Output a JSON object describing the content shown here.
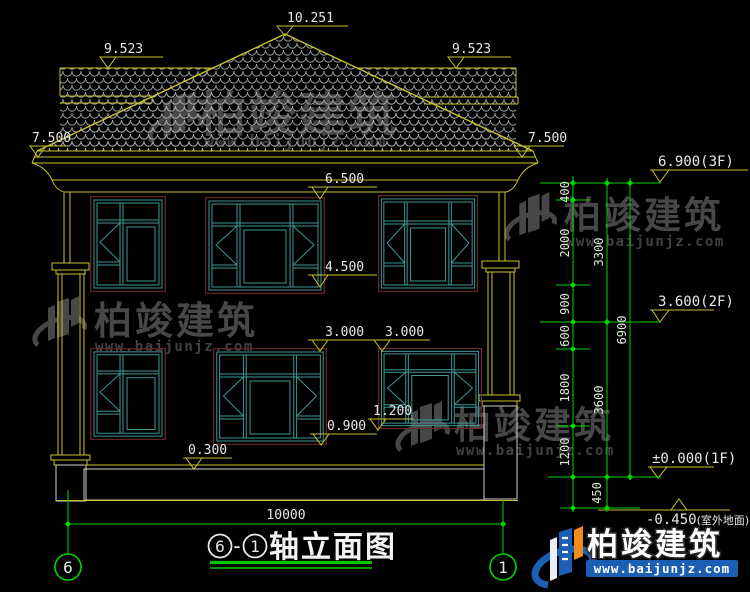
{
  "colors": {
    "background": "#000000",
    "cad_yellow": "#c6c22e",
    "cad_green": "#00d400",
    "window_teal": "#3f9696",
    "frame_dark_red": "#6b2a2a",
    "text_white": "#e8e8e8",
    "watermark_gray": "#474747",
    "logo_blue": "#1a5fb4",
    "logo_orange": "#f08c1e"
  },
  "marks": [
    {
      "value": "10.251"
    },
    {
      "value": "9.523"
    },
    {
      "value": "9.523"
    },
    {
      "value": "7.500"
    },
    {
      "value": "7.500"
    },
    {
      "value": "6.500"
    },
    {
      "value": "4.500"
    },
    {
      "value": "3.000"
    },
    {
      "value": "3.000"
    },
    {
      "value": "0.900"
    },
    {
      "value": "1.200"
    },
    {
      "value": "0.300"
    }
  ],
  "levels": [
    {
      "value": "6.900(3F)"
    },
    {
      "value": "3.600(2F)"
    },
    {
      "value": "±0.000(1F)"
    },
    {
      "value": "-0.450",
      "suffix": "(室外地面)"
    }
  ],
  "chain": {
    "col1": [
      "400",
      "2000",
      "900",
      "600",
      "1800",
      "1200",
      "450"
    ],
    "col2": [
      "3300",
      "3600"
    ],
    "col3": [
      "6900"
    ],
    "span": "10000"
  },
  "axes": {
    "left": "6",
    "right": "1"
  },
  "title": {
    "start": "6",
    "dash": "-",
    "end": "1",
    "label": "轴立面图"
  },
  "watermark": {
    "brand": "柏竣建筑",
    "url": "www.baijunjz.com"
  },
  "brand_badge": {
    "brand": "柏竣建筑",
    "url": "www.baijunjz.com"
  }
}
